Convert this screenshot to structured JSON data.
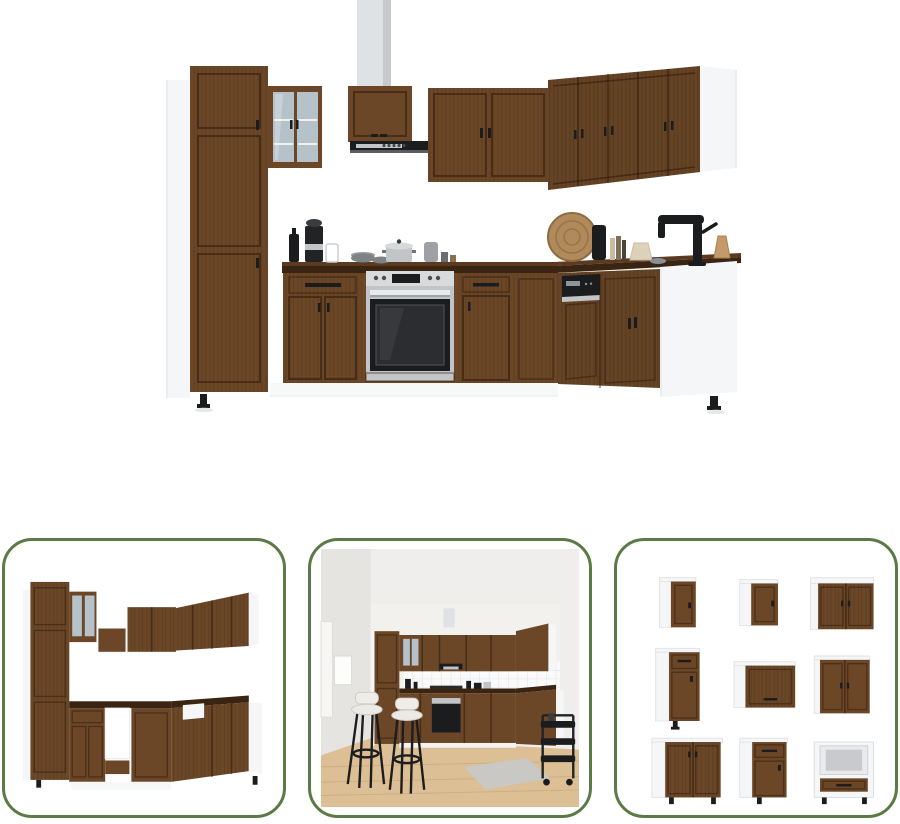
{
  "page": {
    "background": "#ffffff"
  },
  "colors": {
    "page": "#ffffff",
    "accent": "#5a7b46",
    "wood": "#6b4727",
    "wood-dark": "#4a2d16",
    "carcass": "#f5f6f7",
    "counter": "#3a2412",
    "counter-top": "#5c3a21",
    "steel": "#c2c5c8",
    "appliance": "#1b1c1e",
    "glass": "#b6c2ca",
    "duct": "#dfe2e5",
    "duct-shade": "#c6cacd",
    "wall": "#efeeec",
    "tile": "#fafafa",
    "floor": "#dcbf94"
  },
  "main_image": {
    "alt": "L-shaped kitchen cabinet set in brown oak and white with tall pantry, glass wall cabinet, extractor hood, built-in oven, dishwasher panel, black kitchen tap and coffee accessories on the dark worktop"
  },
  "gallery": {
    "items": [
      {
        "id": "angle-view",
        "alt": "Kitchen cabinet set seen from the opposite angle without appliances, open slots for oven and sink"
      },
      {
        "id": "room-scene",
        "alt": "Kitchen cabinet set installed in a room with white tiled splashback, wooden floor, two black bar stools and a serving trolley"
      },
      {
        "id": "module-grid",
        "alt": "The nine individual cabinet modules of the set: wall cabinets, base cabinets with drawers and an oven housing cabinet"
      }
    ]
  }
}
